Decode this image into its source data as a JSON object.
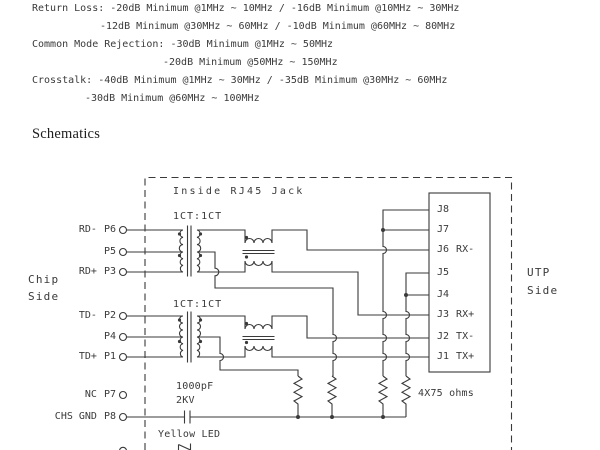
{
  "colors": {
    "ink": "#3a3a3a",
    "background": "#ffffff"
  },
  "specs": {
    "lines": [
      "Return Loss: -20dB Minimum @1MHz ~ 10MHz / -16dB Minimum @10MHz ~ 30MHz",
      "-12dB Minimum @30MHz ~ 60MHz / -10dB Minimum @60MHz ~ 80MHz",
      "Common Mode Rejection: -30dB Minimum @1MHz ~ 50MHz",
      "-20dB Minimum @50MHz ~ 150MHz",
      "Crosstalk: -40dB Minimum @1MHz ~ 30MHz / -35dB Minimum @30MHz ~ 60MHz",
      "-30dB Minimum @60MHz ~ 100MHz"
    ]
  },
  "section": {
    "heading": "Schematics"
  },
  "schematic": {
    "enclosure_label": "Inside RJ45 Jack",
    "ratio_rx": "1CT:1CT",
    "ratio_tx": "1CT:1CT",
    "side_left": {
      "line1": "Chip",
      "line2": "Side"
    },
    "side_right": {
      "line1": "UTP",
      "line2": "Side"
    },
    "cap_value": "1000pF",
    "cap_rating": "2KV",
    "resistor_label": "4X75 ohms",
    "led_label": "Yellow LED",
    "chip_pins": [
      {
        "signal": "RD-",
        "pin": "P6"
      },
      {
        "signal": "",
        "pin": "P5"
      },
      {
        "signal": "RD+",
        "pin": "P3"
      },
      {
        "signal": "TD-",
        "pin": "P2"
      },
      {
        "signal": "",
        "pin": "P4"
      },
      {
        "signal": "TD+",
        "pin": "P1"
      },
      {
        "signal": "NC",
        "pin": "P7"
      },
      {
        "signal": "CHS GND",
        "pin": "P8"
      }
    ],
    "jack_pins": [
      {
        "pin": "J8",
        "signal": ""
      },
      {
        "pin": "J7",
        "signal": ""
      },
      {
        "pin": "J6",
        "signal": "RX-"
      },
      {
        "pin": "J5",
        "signal": ""
      },
      {
        "pin": "J4",
        "signal": ""
      },
      {
        "pin": "J3",
        "signal": "RX+"
      },
      {
        "pin": "J2",
        "signal": "TX-"
      },
      {
        "pin": "J1",
        "signal": "TX+"
      }
    ]
  }
}
